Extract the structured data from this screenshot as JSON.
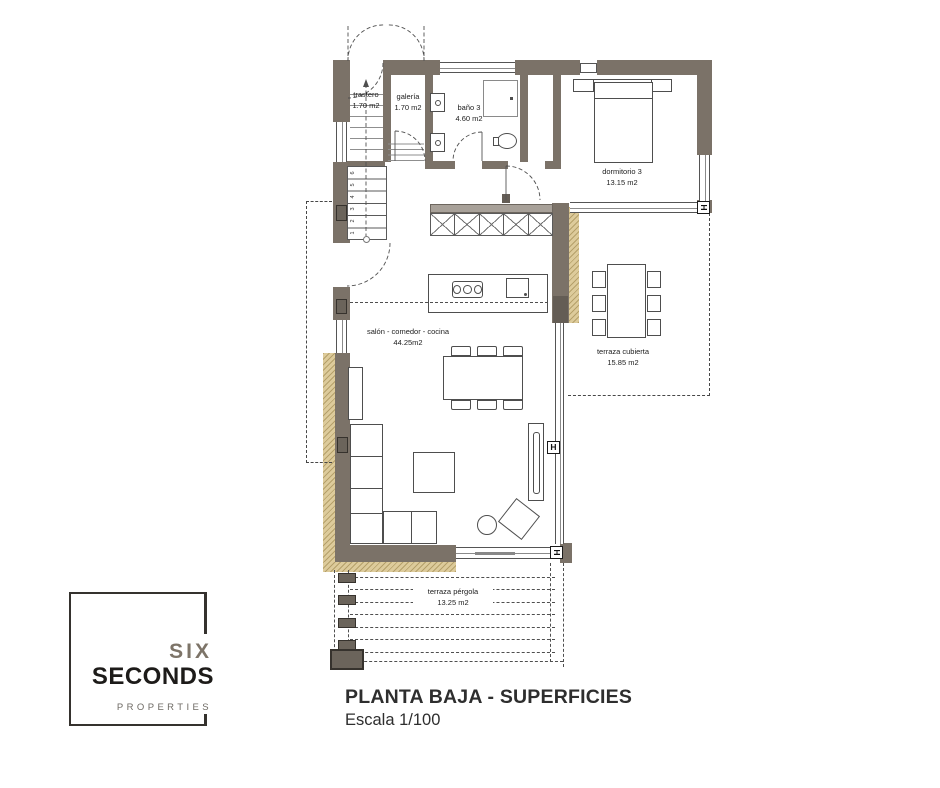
{
  "logo": {
    "line1": "SIX",
    "line2": "SECONDS",
    "line3": "PROPERTIES"
  },
  "title": {
    "main": "PLANTA BAJA - SUPERFICIES",
    "scale": "Escala 1/100"
  },
  "plan": {
    "rooms": [
      {
        "name": "trastero",
        "area": "1.70 m2"
      },
      {
        "name": "galería",
        "area": "1.70 m2"
      },
      {
        "name": "baño 3",
        "area": "4.60 m2"
      },
      {
        "name": "dormitorio 3",
        "area": "13.15 m2"
      },
      {
        "name": "salón - comedor - cocina",
        "area": "44.25m2"
      },
      {
        "name": "terraza cubierta",
        "area": "15.85 m2"
      },
      {
        "name": "terraza pérgola",
        "area": "13.25 m2"
      }
    ],
    "stairs": {
      "steps": [
        "1",
        "2",
        "3",
        "4",
        "5",
        "6"
      ]
    },
    "symbols": {
      "handle": "H"
    },
    "colors": {
      "wall": "#7b7268",
      "wall_dark": "#645d55",
      "hatch_bg": "#ddcb9b",
      "hatch_line": "#b5a06a",
      "line": "#4f4f4f"
    }
  }
}
